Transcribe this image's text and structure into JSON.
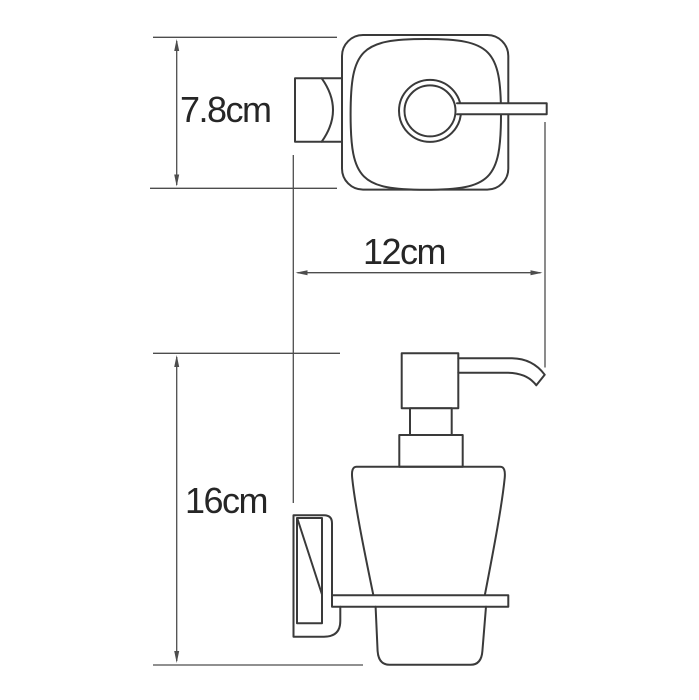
{
  "drawing": {
    "background_color": "#ffffff",
    "outline_color": "#3a3a3a",
    "dimension_color": "#4d4d4d",
    "label_color": "#262626",
    "dimensions": {
      "bracket_depth": {
        "label": "7.8cm"
      },
      "reach_width": {
        "label": "12cm"
      },
      "overall_height": {
        "label": "16cm"
      }
    }
  }
}
